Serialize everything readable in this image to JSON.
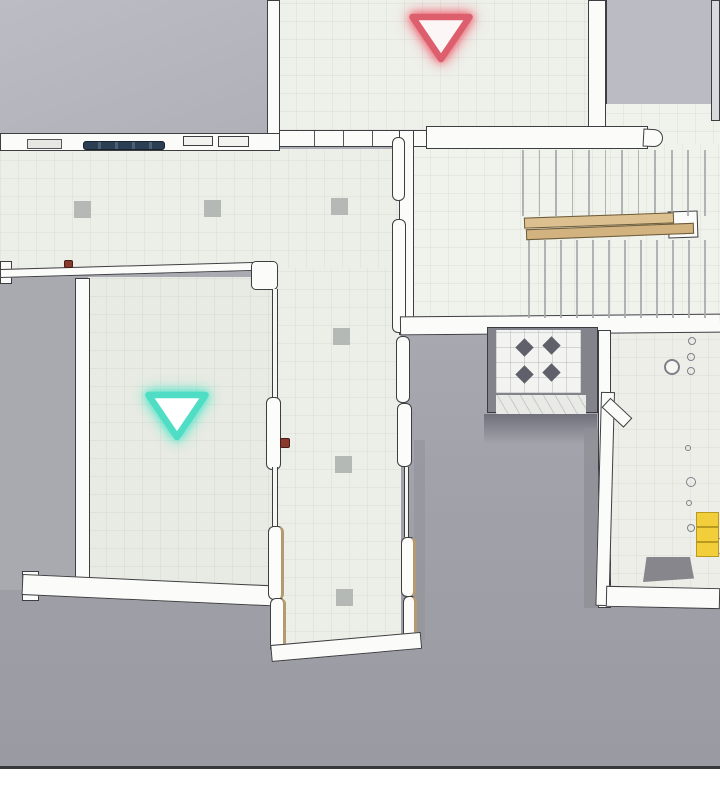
{
  "scene": {
    "description": "Top-down orthographic view of a 3D interior level map with two glowing waypoint markers, an L-shaped corridor, a staircase with wooden handrails, an elevator cell with diamond tiles and a lower-right bathroom area",
    "colors": {
      "background_gray_top": "#b3b3bb",
      "background_gray_bottom": "#9a9aa2",
      "floor_light": "#ecefe8",
      "floor_room": "#e8ebe3",
      "floor_stairwell": "#f0f2ec",
      "wall_fill": "#fbfbf9",
      "wall_outline": "#3e3e42",
      "marker_red": "#dd5f6d",
      "marker_red_glow": "rgba(236,90,105,0.8)",
      "marker_teal": "#4fdec5",
      "marker_teal_glow": "rgba(82,228,200,0.85)",
      "rail_wood": "#dcc08f",
      "rail_wood_dark": "#d2b27f",
      "navy_fixture": "#2c3e52",
      "yellow_object": "#f2cf3a",
      "yellow_edge": "#b89a20",
      "column_marker": "#b5b9b5",
      "tread_line": "#a4a8aa",
      "diamond_tile": "#60606a",
      "door_handle_red": "#8a3a2c",
      "baseline": "#38383c"
    },
    "markers": [
      {
        "name": "red-waypoint",
        "shape": "triangle-down",
        "cx": 441,
        "cy": 33,
        "w": 57,
        "h": 42
      },
      {
        "name": "teal-waypoint",
        "shape": "triangle-down",
        "cx": 177,
        "cy": 411,
        "w": 57,
        "h": 42
      }
    ],
    "column_markers": {
      "size": 17,
      "positions": [
        [
          74,
          201
        ],
        [
          204,
          200
        ],
        [
          331,
          198
        ],
        [
          333,
          328
        ],
        [
          335,
          456
        ],
        [
          336,
          589
        ]
      ]
    },
    "stairs": {
      "upper_flight": {
        "x_start": 522,
        "x_end": 704,
        "y_top": 150,
        "height": 66,
        "treads": 12
      },
      "lower_flight": {
        "x_start": 528,
        "x_end": 704,
        "y_top": 240,
        "height": 78,
        "treads": 12
      },
      "handrails": [
        {
          "x": 524,
          "y": 215,
          "w": 150,
          "h": 11,
          "angle": -2.0,
          "tone": "light"
        },
        {
          "x": 526,
          "y": 226,
          "w": 168,
          "h": 11,
          "angle": -2.2,
          "tone": "dark"
        }
      ]
    },
    "elevator_diamonds": {
      "size": 13,
      "centers": [
        [
          524,
          347
        ],
        [
          551,
          345
        ],
        [
          524,
          374
        ],
        [
          551,
          372
        ]
      ]
    },
    "bathroom_fixtures": [
      {
        "x": 672,
        "y": 367,
        "r": 8,
        "ring": true
      },
      {
        "x": 692,
        "y": 341,
        "r": 4
      },
      {
        "x": 691,
        "y": 357,
        "r": 4
      },
      {
        "x": 691,
        "y": 371,
        "r": 4
      },
      {
        "x": 688,
        "y": 448,
        "r": 3
      },
      {
        "x": 691,
        "y": 482,
        "r": 5
      },
      {
        "x": 689,
        "y": 503,
        "r": 3
      },
      {
        "x": 691,
        "y": 528,
        "r": 4
      }
    ],
    "yellow_stack": {
      "x": 696,
      "y": 512,
      "w": 23,
      "segment_h": 15,
      "segments": 3,
      "white_knob": {
        "x": 710,
        "y": 538,
        "r": 8
      }
    },
    "red_marks": [
      {
        "name": "door-handle",
        "x": 280,
        "y": 438,
        "w": 10,
        "h": 10
      },
      {
        "name": "fence-mark",
        "x": 64,
        "y": 260,
        "w": 9,
        "h": 8
      }
    ]
  }
}
